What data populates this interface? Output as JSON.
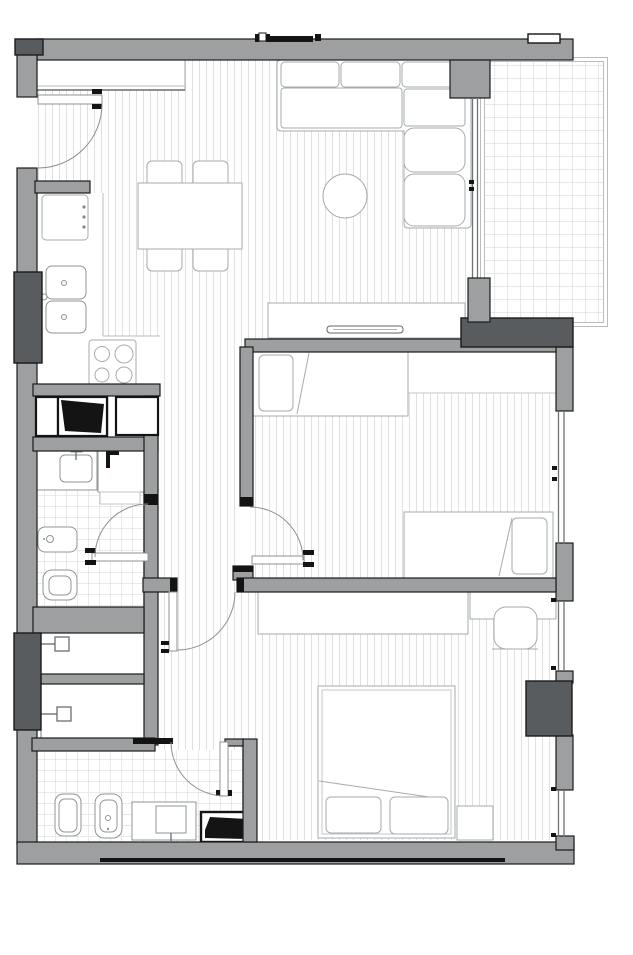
{
  "meta": {
    "kind": "architectural-floor-plan",
    "has_text_labels": false
  },
  "colors": {
    "background": "#ffffff",
    "wall": "#9d9fa1",
    "wall_dark": "#595c5e",
    "outline": "#1b1b1b",
    "floor_hatch": "#e0e0e3",
    "tile_line": "#d5d6d9",
    "balcony_line": "#cfd0d3",
    "furniture_line": "#a6abae",
    "fixture_line": "#8f9497",
    "door_arc": "#8f8f8f",
    "window_line": "#6e7375",
    "black_detail": "#141414"
  }
}
